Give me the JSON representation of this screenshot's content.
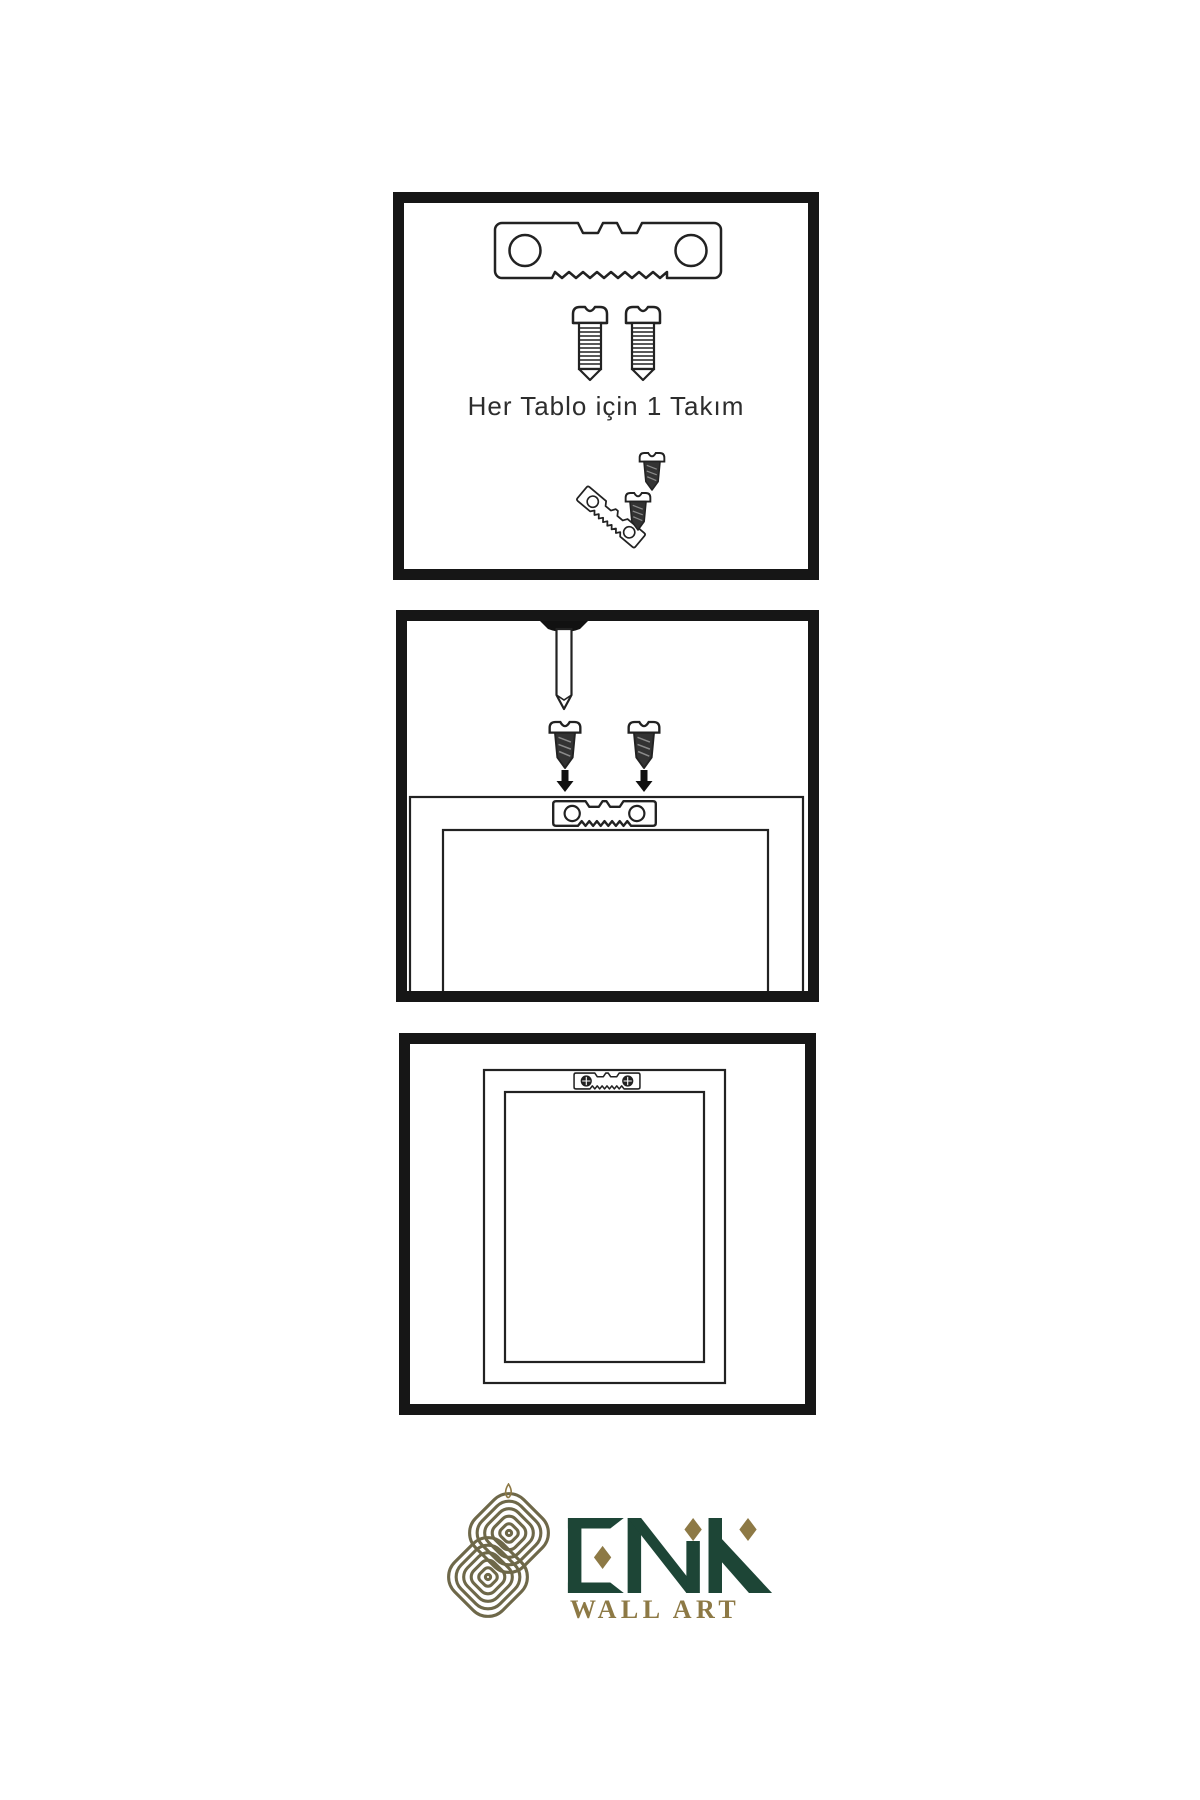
{
  "sheet": {
    "background": "#ffffff",
    "caption": "Her Tablo için 1 Takım",
    "panels": [
      {
        "name": "hardware-kit",
        "items": [
          "sawtooth-hanger-icon",
          "screw-icon",
          "screw-icon",
          "screw-into-hanger-icon"
        ]
      },
      {
        "name": "wall-mounting",
        "items": [
          "wall-nail-icon",
          "screw-icon",
          "screw-icon",
          "down-arrow-icon",
          "down-arrow-icon",
          "frame-back-with-hanger"
        ]
      },
      {
        "name": "hanging-result",
        "items": [
          "framed-picture-with-hanger"
        ]
      }
    ]
  },
  "logo": {
    "name": "ENK",
    "subtitle": "WALL ART",
    "green": "#1d4536",
    "gold": "#8d7945",
    "knot_color": "#6e6849"
  },
  "colors": {
    "outline": "#222222",
    "dark_fill": "#333333",
    "panel_border": "#161616"
  }
}
